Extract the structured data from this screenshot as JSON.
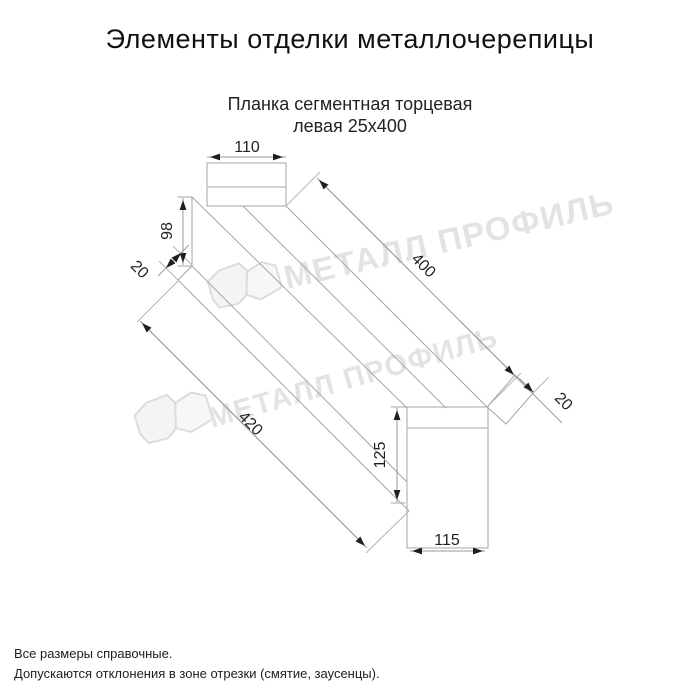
{
  "title": "Элементы отделки металлочерепицы",
  "subtitle": {
    "line1": "Планка сегментная торцевая",
    "line2": "левая 25х400"
  },
  "watermark": {
    "brand": "МЕТАЛЛ ПРОФИЛЬ"
  },
  "dimensions": {
    "top_flap_width": "110",
    "left_end_height": "98",
    "left_fold": "20",
    "strip_length": "400",
    "end_fold": "20",
    "bottom_edge_length": "420",
    "end_flap_height": "125",
    "end_flap_width": "115"
  },
  "footer": {
    "line1": "Все размеры справочные.",
    "line2": "Допускаются отклонения в зоне отрезки (смятие, заусенцы)."
  },
  "colors": {
    "geometry_line": "#a6a6a6",
    "dimension_line": "#9a9a9a",
    "dimension_text": "#222222",
    "watermark": "#e3e3e3"
  }
}
